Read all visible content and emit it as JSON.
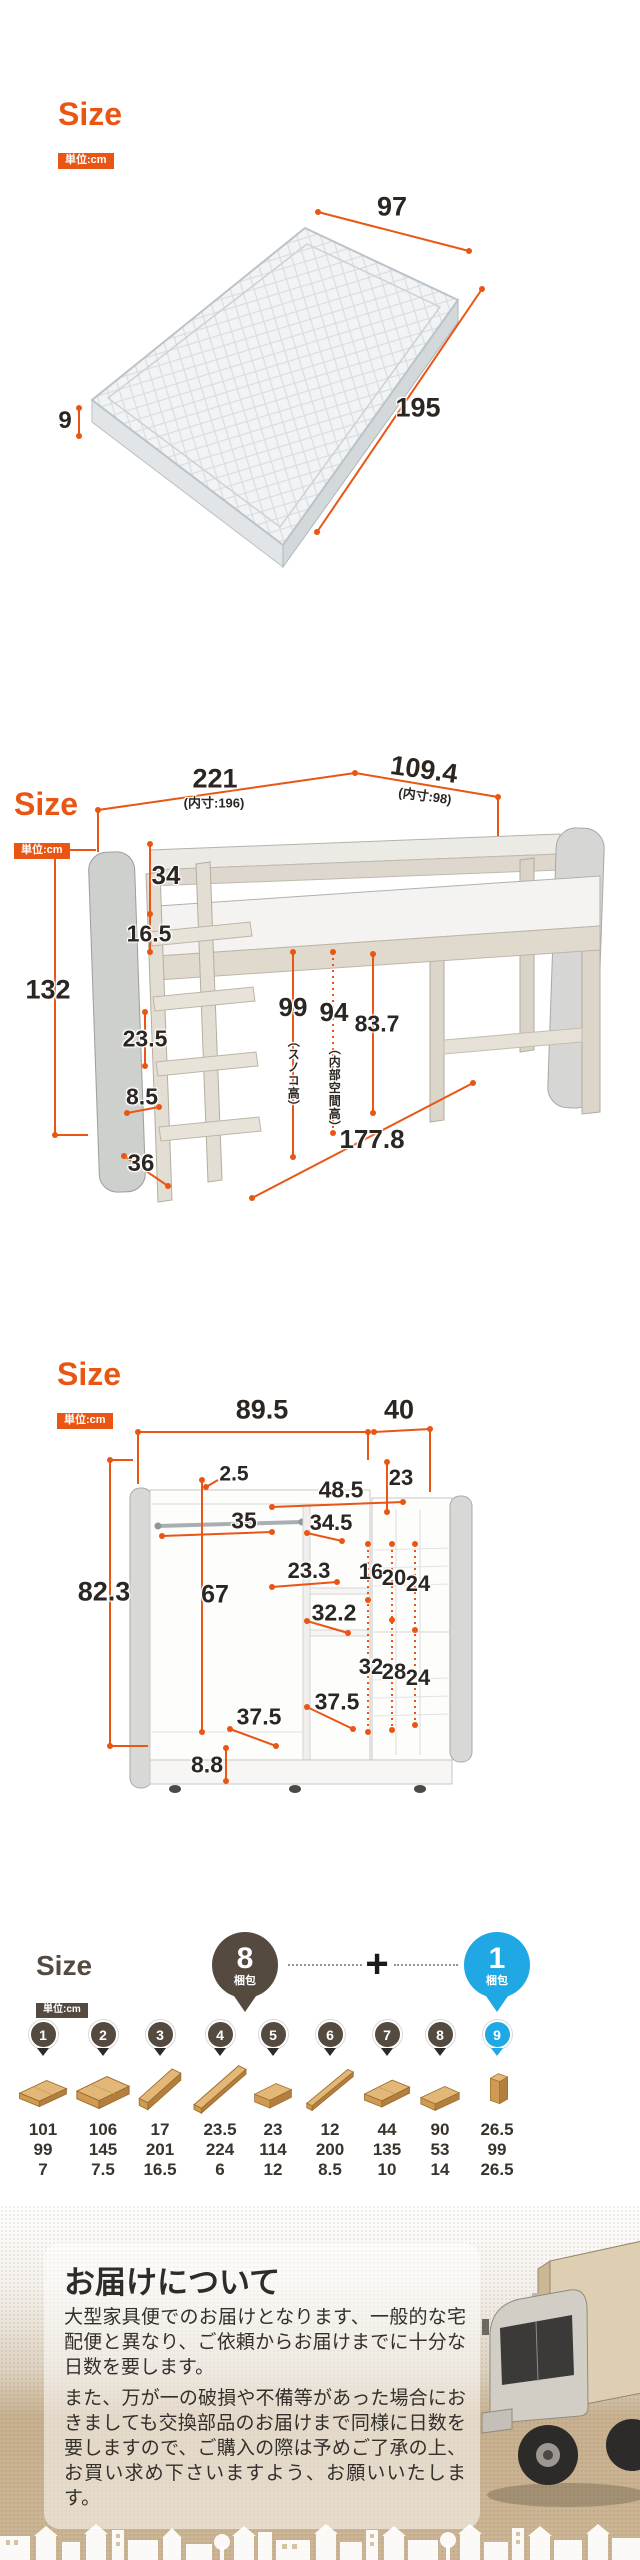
{
  "colors": {
    "accent_orange": "#e95513",
    "badge_brown": "#544a40",
    "badge_blue": "#1fa8e4"
  },
  "mattress_section": {
    "size_label": "Size",
    "unit_label": "単位:cm",
    "width": "97",
    "length": "195",
    "thickness": "9"
  },
  "bed_section": {
    "size_label": "Size",
    "unit_label": "単位:cm",
    "width": "221",
    "width_inner": "(内寸:196)",
    "depth": "109.4",
    "depth_inner": "(内寸:98)",
    "height": "132",
    "guard_height": "34",
    "guard_gap": "16.5",
    "step_pitch": "23.5",
    "step_depth": "8.5",
    "ladder_width": "36",
    "slat_height": "99",
    "slat_height_note": "（スノコ高）",
    "inner_height": "94",
    "inner_height_note": "（内部空間高）",
    "under_clearance": "83.7",
    "under_width": "177.8"
  },
  "wardrobe_section": {
    "size_label": "Size",
    "unit_label": "単位:cm",
    "main_width": "89.5",
    "side_width": "40",
    "height": "82.3",
    "rod_diameter": "2.5",
    "side_top_inner": "23",
    "upper_inner_width": "48.5",
    "left_inner_width": "35",
    "upper_shelf_width": "34.5",
    "mid_shelf_width": "23.3",
    "slot_top_1": "16",
    "slot_top_2": "20",
    "slot_top_3": "24",
    "left_inner_height": "67",
    "mid_inner_width": "32.2",
    "slot_bottom_1": "32",
    "slot_bottom_2": "28",
    "slot_bottom_3": "24",
    "bottom_depth_left": "37.5",
    "bottom_depth_right": "37.5",
    "base_height": "8.8"
  },
  "packing_section": {
    "size_label": "Size",
    "unit_label": "単位:cm",
    "main_count": "8",
    "main_count_label": "梱包",
    "plus": "+",
    "extra_count": "1",
    "extra_count_label": "梱包",
    "items": [
      {
        "no": "1",
        "w": "101",
        "d": "99",
        "h": "7"
      },
      {
        "no": "2",
        "w": "106",
        "d": "145",
        "h": "7.5"
      },
      {
        "no": "3",
        "w": "17",
        "d": "201",
        "h": "16.5"
      },
      {
        "no": "4",
        "w": "23.5",
        "d": "224",
        "h": "6"
      },
      {
        "no": "5",
        "w": "23",
        "d": "114",
        "h": "12"
      },
      {
        "no": "6",
        "w": "12",
        "d": "200",
        "h": "8.5"
      },
      {
        "no": "7",
        "w": "44",
        "d": "135",
        "h": "10"
      },
      {
        "no": "8",
        "w": "90",
        "d": "53",
        "h": "14"
      },
      {
        "no": "9",
        "w": "26.5",
        "d": "99",
        "h": "26.5"
      }
    ]
  },
  "delivery_section": {
    "title": "お届けについて",
    "paragraph1": "大型家具便でのお届けとなります、一般的な宅配便と異なり、ご依頼からお届けまでに十分な日数を要します。",
    "paragraph2": "また、万が一の破損や不備等があった場合におきましても交換部品のお届けまで同様に日数を要しますので、ご購入の際は予めご了承の上、お買い求め下さいますよう、お願いいたします。"
  }
}
